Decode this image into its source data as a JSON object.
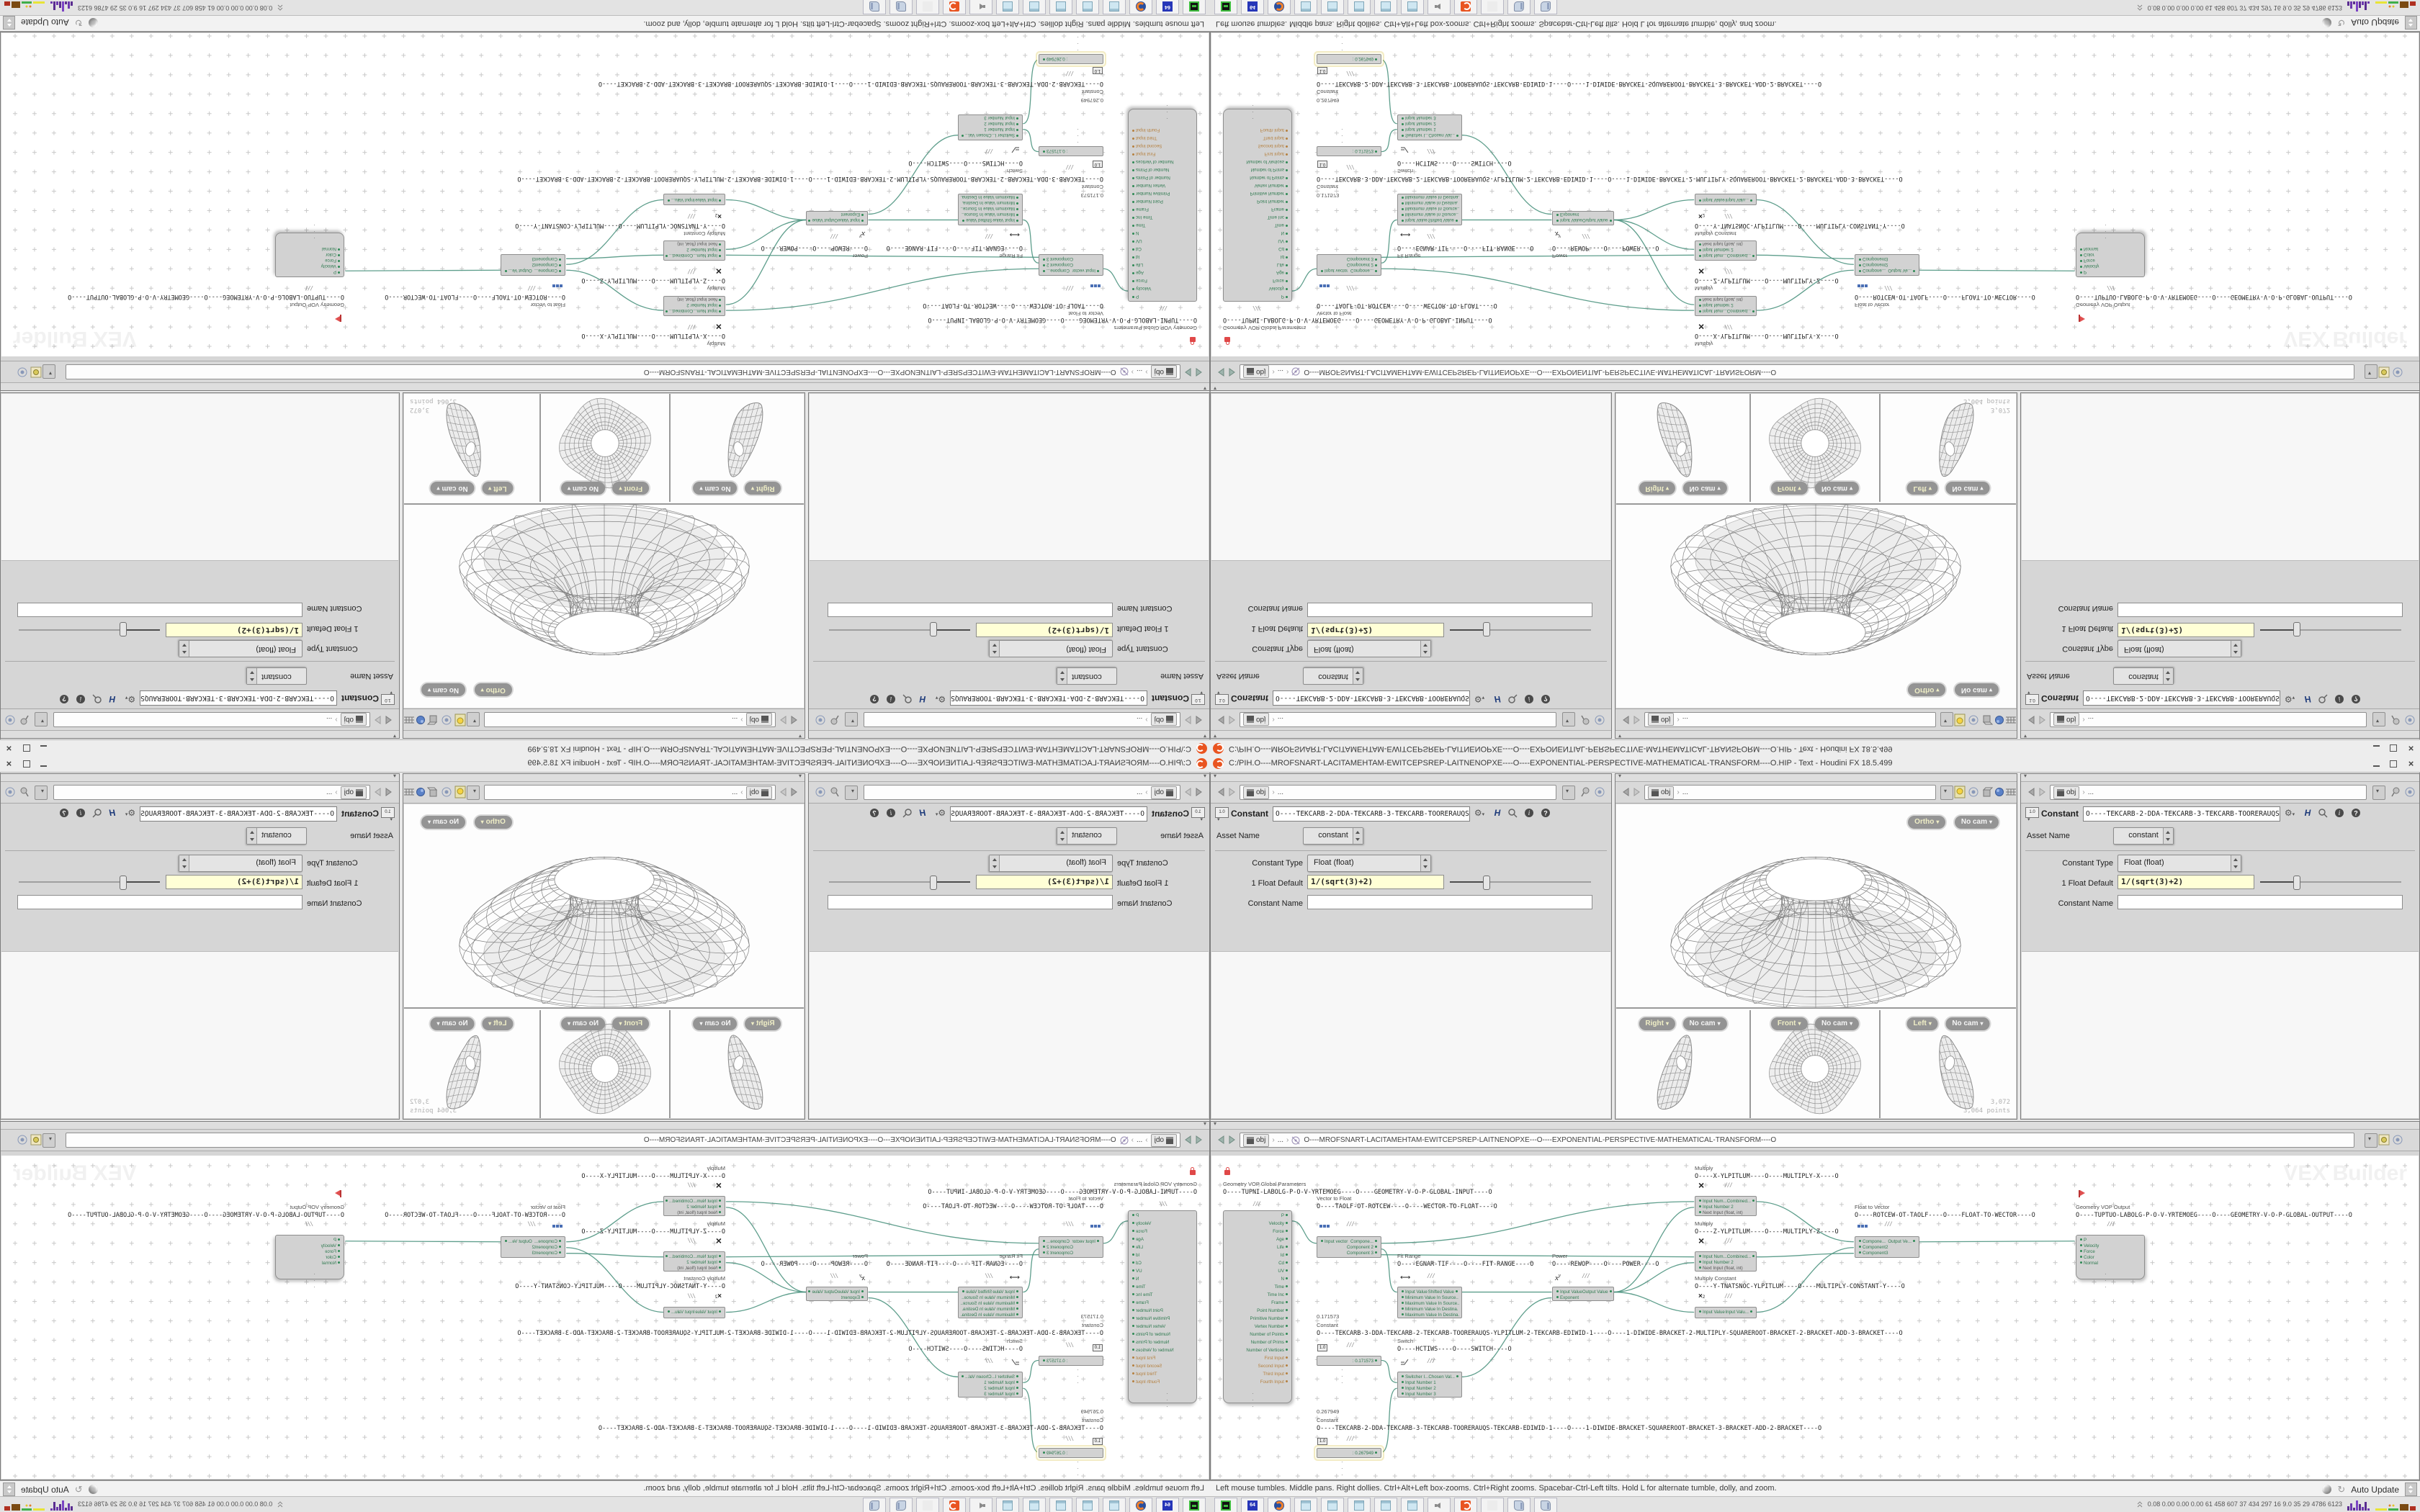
{
  "title_bar": {
    "title": "C:/PIH.O----MROFSNART-LACITAMEHTAM-EWITCEPSREP-LAITNENOPXE----O----EXPONENTIAL-PERSPECTIVE-MATHEMATICAL-TRANSFORM----O.HIP - Text - Houdini FX 18.5.499",
    "close_label": "×"
  },
  "nav": {
    "obj": "obj",
    "dots": "...",
    "chevron": "›"
  },
  "params": {
    "node_type": "Constant",
    "name_field": "O----TEKCARB-2-DDA-TEKCARB-3-TEKCARB-TOORERAUQS-TEKCA",
    "asset_label": "Asset Name",
    "asset_value": "constant",
    "type_label": "Constant Type",
    "type_value": "Float (float)",
    "default_label": "1 Float Default",
    "default_value": "1/(sqrt(3)+2)",
    "cname_label": "Constant Name",
    "cname_value": "",
    "help_h": "H"
  },
  "viewport": {
    "persp_pill": "Ortho",
    "cam_pill": "No cam",
    "views": [
      {
        "label": "Right",
        "cam": "No cam"
      },
      {
        "label": "Front",
        "cam": "No cam"
      },
      {
        "label": "Left",
        "cam": "No cam"
      }
    ],
    "stats": [
      "3,072",
      "3,064 points"
    ]
  },
  "network": {
    "path": "O----MROFSNART-LACITAMEHTAM-EWITCEPSREP-LAITNENOPXE---O----EXPONENTIAL-PERSPECTIVE-MATHEMATICAL-TRANSFORM----O",
    "watermark": "VEX Builder",
    "nodes": [
      {
        "id": "global",
        "title": "Geometry VOP Global Parameters",
        "name": "O----TUPNI-LABOLG-P-O-V-YRTEMOEG----O----GEOMETRY-V-O-P-GLOBAL-INPUT----O",
        "outputs": [
          "P",
          "Velocity",
          "Force",
          "Age",
          "Life",
          "Id",
          "Cd",
          "UV",
          "N",
          "Time",
          "Time Inc",
          "Frame",
          "Point Number",
          "Primitive Number",
          "Vertex Number",
          "Number of Points",
          "Number of Prims",
          "Number of Vertices"
        ],
        "op_outputs": [
          "First Input",
          "Second Input",
          "Third Input",
          "Fourth Input"
        ]
      },
      {
        "id": "vtf",
        "title": "Vector to Float",
        "name": "O----TAOLF-OT-ROTCEW----O----WECTOR-TO-FLOAT----O",
        "rows": [
          {
            "l": "Input vector",
            "r": "Compone..."
          },
          {
            "r": "Component 2"
          },
          {
            "r": "Component 3"
          }
        ]
      },
      {
        "id": "fit",
        "title": "Fit Range",
        "name": "O----EGNAR-TIF----O----FIT-RANGE----O",
        "rows": [
          {
            "l": "Input Value",
            "r": "Shifted Value"
          },
          {
            "l": "Minimum Value In Source.."
          },
          {
            "l": "Maximum Value In Source.."
          },
          {
            "l": "Minimum Value In Destina."
          },
          {
            "l": "Maximum Value In Destina."
          }
        ]
      },
      {
        "id": "power",
        "title": "Power",
        "name": "O----REWOP----O----POWER----O",
        "rows": [
          {
            "l": "Input Value",
            "r": "Output Value"
          },
          {
            "l": "Exponent"
          }
        ]
      },
      {
        "id": "mulx",
        "title": "Multiply",
        "name": "O----X-YLPITLUM----O----MULTIPLY-X----O",
        "rows": [
          {
            "l": "Input Num...",
            "r": "Combined..."
          },
          {
            "l": "Input Number 2"
          },
          {
            "l": "Next Input (float, int)",
            "dim": true
          }
        ]
      },
      {
        "id": "mulz",
        "title": "Multiply",
        "name": "O----Z-YLPITLUM----O----MULTIPLY-Z----O",
        "rows": [
          {
            "l": "Input Num...",
            "r": "Combined..."
          },
          {
            "l": "Input Number 2"
          },
          {
            "l": "Next Input (float, int)",
            "dim": true
          }
        ]
      },
      {
        "id": "muly",
        "title": "Multiply Constant",
        "name": "O----Y-TNATSNOC-YLPITLUM----O----MULTIPLY-CONSTANT-Y----O",
        "rows": [
          {
            "l": "Input Value",
            "r": "Input Valu..."
          }
        ]
      },
      {
        "id": "const1",
        "title": "Constant",
        "value": "0.171573",
        "name": "O----TEKCARB-3-DDA-TEKCARB-2-TEKCARB-TOORERAUQS-YLPITLUM-2-TEKCARB-EDIWID-1----O----1-DIWIDE-BRACKET-2-MULTIPLY-SQUAREROOT-BRACKET-2-BRACKET-ADD-3-BRACKET----O",
        "rows": [
          {
            "r": ": 0.171573"
          }
        ]
      },
      {
        "id": "switch",
        "title": "Switch",
        "name": "O----HCTIWS----O----SWITCH----O",
        "rows": [
          {
            "l": "Switcher I...",
            "r": "Chosen Val..."
          },
          {
            "l": "Input Number 1"
          },
          {
            "l": "Input Number 2"
          },
          {
            "l": "Input Number 3"
          }
        ]
      },
      {
        "id": "const2",
        "title": "Constant",
        "value": "0.267949",
        "selected": true,
        "name": "O----TEKCARB-2-DDA-TEKCARB-3-TEKCARB-TOORERAUQS-TEKCARB-EDIWID-1----O----1-DIWIDE-BRACKET-SQUAREROOT-BRACKET-3-BRACKET-ADD-2-BRACKET----O",
        "rows": [
          {
            "r": ": 0.267949"
          }
        ]
      },
      {
        "id": "ftv",
        "title": "Float to Vector",
        "name": "O----ROTCEW-OT-TAOLF----O----FLOAT-TO-WECTOR----O",
        "rows": [
          {
            "l": "Compone...",
            "r": "Output Ve..."
          },
          {
            "l": "Component2"
          },
          {
            "l": "Component3"
          }
        ]
      },
      {
        "id": "out",
        "title": "Geometry VOP Output",
        "name": "O----TUPTUO-LABOLG-P-O-V-YRTEMOEG----O----GEOMETRY-V-O-P-GLOBAL-OUTPUT----O",
        "rows": [
          {
            "l": "P"
          },
          {
            "l": "Velocity"
          },
          {
            "l": "Force"
          },
          {
            "l": "Color"
          },
          {
            "l": "Normal"
          }
        ]
      }
    ]
  },
  "status": {
    "message": "Left mouse tumbles. Middle pans. Right dollies. Ctrl+Alt+Left box-zooms. Ctrl+Right zooms. Spacebar-Ctrl-Left tilts. Hold L for alternate tumble, dolly, and zoom.",
    "auto_update": "Auto Update"
  },
  "taskbar": {
    "apps": [
      "terminal",
      "hxd",
      "firefox",
      "notepad",
      "notepad",
      "notepad",
      "notepad",
      "notepad",
      "speaker",
      "houdini",
      "ghost",
      "scroll",
      "scroll"
    ],
    "hxd_label": "64",
    "perf": "0.08 0.00 0.00 0.00   61   458  607   37   434  297   16   9.0   35   29  4786 6123"
  },
  "colors": {
    "accent_orange": "#e95420",
    "wire_teal": "#4c9480",
    "port_green": "#2f7a50",
    "port_orange": "#b5803f",
    "expr_field_yellow": "#ffffd6"
  }
}
